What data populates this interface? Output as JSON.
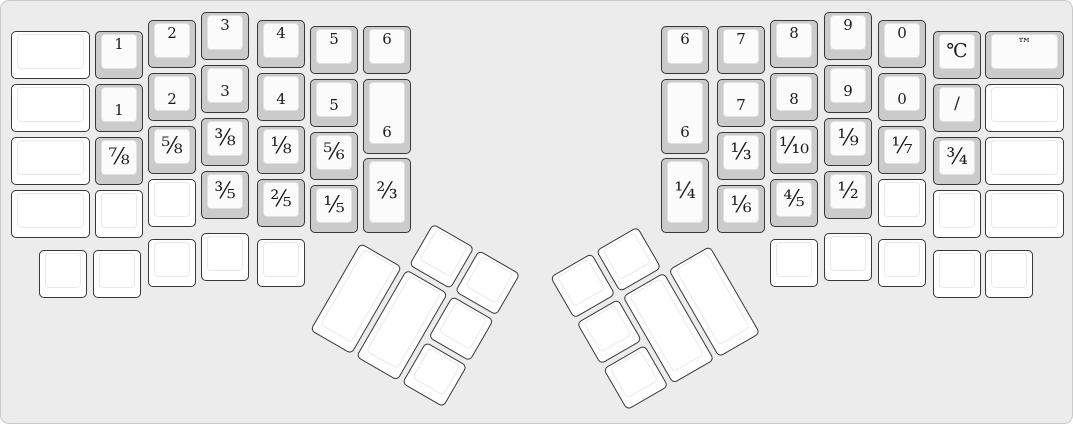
{
  "canvas": {
    "width": 1073,
    "height": 424,
    "background": "#ececec",
    "border_color": "#c9c9c9"
  },
  "key_style": {
    "labeled_base": "#cbcbcb",
    "labeled_top": "#fbfbfb",
    "blank_base": "#ffffff",
    "blank_top": "#ffffff",
    "outline": "#383838",
    "legend_color": "#1b1b1b",
    "unit_w": 48,
    "unit_h": 48
  },
  "groups": [
    {
      "name": "left-hand-main-keys",
      "rotation": 0,
      "origin": [
        0,
        0
      ],
      "keys": [
        {
          "x": 10,
          "y": 30,
          "w": 79,
          "label": "",
          "a": "c"
        },
        {
          "x": 10,
          "y": 83,
          "w": 79,
          "label": "",
          "a": "c"
        },
        {
          "x": 10,
          "y": 136,
          "w": 79,
          "label": "",
          "a": "c"
        },
        {
          "x": 10,
          "y": 189,
          "w": 79,
          "label": "",
          "a": "c"
        },
        {
          "x": 94,
          "y": 30,
          "label": "1",
          "a": "t"
        },
        {
          "x": 94,
          "y": 83,
          "label": "1",
          "a": "b"
        },
        {
          "x": 94,
          "y": 136,
          "label": "⅞",
          "a": "c"
        },
        {
          "x": 94,
          "y": 189,
          "label": "",
          "a": "c"
        },
        {
          "x": 147,
          "y": 19,
          "label": "2",
          "a": "t"
        },
        {
          "x": 147,
          "y": 72,
          "label": "2",
          "a": "b"
        },
        {
          "x": 147,
          "y": 125,
          "label": "⅝",
          "a": "c"
        },
        {
          "x": 147,
          "y": 178,
          "label": "",
          "a": "c"
        },
        {
          "x": 200,
          "y": 11,
          "label": "3",
          "a": "t"
        },
        {
          "x": 200,
          "y": 64,
          "label": "3",
          "a": "b"
        },
        {
          "x": 200,
          "y": 117,
          "label": "⅜",
          "a": "c"
        },
        {
          "x": 200,
          "y": 170,
          "label": "⅗",
          "a": "c"
        },
        {
          "x": 256,
          "y": 19,
          "label": "4",
          "a": "t"
        },
        {
          "x": 256,
          "y": 72,
          "label": "4",
          "a": "b"
        },
        {
          "x": 256,
          "y": 125,
          "label": "⅛",
          "a": "c"
        },
        {
          "x": 256,
          "y": 178,
          "label": "⅖",
          "a": "c"
        },
        {
          "x": 309,
          "y": 25,
          "label": "5",
          "a": "t"
        },
        {
          "x": 309,
          "y": 78,
          "label": "5",
          "a": "b"
        },
        {
          "x": 309,
          "y": 131,
          "label": "⅚",
          "a": "c"
        },
        {
          "x": 309,
          "y": 184,
          "label": "⅕",
          "a": "c"
        },
        {
          "x": 362,
          "y": 25,
          "label": "6",
          "a": "t"
        },
        {
          "x": 362,
          "y": 78,
          "h": 75,
          "label": "6",
          "a": "b"
        },
        {
          "x": 362,
          "y": 157,
          "h": 75,
          "label": "⅔",
          "a": "c"
        },
        {
          "x": 38,
          "y": 249,
          "label": "",
          "a": "c"
        },
        {
          "x": 92,
          "y": 249,
          "label": "",
          "a": "c"
        },
        {
          "x": 147,
          "y": 238,
          "label": "",
          "a": "c"
        },
        {
          "x": 200,
          "y": 232,
          "label": "",
          "a": "c"
        },
        {
          "x": 256,
          "y": 238,
          "label": "",
          "a": "c"
        }
      ]
    },
    {
      "name": "right-hand-main-keys",
      "rotation": 0,
      "origin": [
        0,
        0
      ],
      "keys": [
        {
          "x": 660,
          "y": 25,
          "label": "6",
          "a": "t"
        },
        {
          "x": 660,
          "y": 78,
          "h": 75,
          "label": "6",
          "a": "b"
        },
        {
          "x": 660,
          "y": 157,
          "h": 75,
          "label": "¼",
          "a": "c"
        },
        {
          "x": 716,
          "y": 25,
          "label": "7",
          "a": "t"
        },
        {
          "x": 716,
          "y": 78,
          "label": "7",
          "a": "b"
        },
        {
          "x": 716,
          "y": 131,
          "label": "⅓",
          "a": "c"
        },
        {
          "x": 716,
          "y": 184,
          "label": "⅙",
          "a": "c"
        },
        {
          "x": 769,
          "y": 19,
          "label": "8",
          "a": "t"
        },
        {
          "x": 769,
          "y": 72,
          "label": "8",
          "a": "b"
        },
        {
          "x": 769,
          "y": 125,
          "label": "⅒",
          "a": "c"
        },
        {
          "x": 769,
          "y": 178,
          "label": "⅘",
          "a": "c"
        },
        {
          "x": 823,
          "y": 11,
          "label": "9",
          "a": "t"
        },
        {
          "x": 823,
          "y": 64,
          "label": "9",
          "a": "b"
        },
        {
          "x": 823,
          "y": 117,
          "label": "⅑",
          "a": "c"
        },
        {
          "x": 823,
          "y": 170,
          "label": "½",
          "a": "c"
        },
        {
          "x": 877,
          "y": 19,
          "label": "0",
          "a": "t"
        },
        {
          "x": 877,
          "y": 72,
          "label": "0",
          "a": "b"
        },
        {
          "x": 877,
          "y": 125,
          "label": "⅐",
          "a": "c"
        },
        {
          "x": 877,
          "y": 178,
          "label": "",
          "a": "c"
        },
        {
          "x": 932,
          "y": 30,
          "label": "℃",
          "a": "c"
        },
        {
          "x": 932,
          "y": 83,
          "label": "/",
          "a": "c"
        },
        {
          "x": 932,
          "y": 136,
          "label": "¾",
          "a": "c"
        },
        {
          "x": 932,
          "y": 189,
          "label": "",
          "a": "c"
        },
        {
          "x": 984,
          "y": 30,
          "w": 79,
          "label": "™",
          "a": "t"
        },
        {
          "x": 984,
          "y": 83,
          "w": 79,
          "label": "",
          "a": "c"
        },
        {
          "x": 984,
          "y": 136,
          "w": 79,
          "label": "",
          "a": "c"
        },
        {
          "x": 984,
          "y": 189,
          "w": 79,
          "label": "",
          "a": "c"
        },
        {
          "x": 769,
          "y": 238,
          "label": "",
          "a": "c"
        },
        {
          "x": 823,
          "y": 232,
          "label": "",
          "a": "c"
        },
        {
          "x": 877,
          "y": 238,
          "label": "",
          "a": "c"
        },
        {
          "x": 932,
          "y": 249,
          "label": "",
          "a": "c"
        },
        {
          "x": 984,
          "y": 249,
          "label": "",
          "a": "c"
        }
      ]
    },
    {
      "name": "left-thumb-cluster",
      "rotation": 30,
      "origin": [
        386,
        196
      ],
      "keys": [
        {
          "x": 53,
          "y": 0,
          "label": "",
          "a": "c"
        },
        {
          "x": 106,
          "y": 0,
          "label": "",
          "a": "c"
        },
        {
          "x": 0,
          "y": 53,
          "h": 101,
          "label": "",
          "a": "c"
        },
        {
          "x": 53,
          "y": 53,
          "h": 101,
          "label": "",
          "a": "c"
        },
        {
          "x": 106,
          "y": 53,
          "label": "",
          "a": "c"
        },
        {
          "x": 106,
          "y": 106,
          "label": "",
          "a": "c"
        }
      ]
    },
    {
      "name": "right-thumb-cluster",
      "rotation": -30,
      "origin": [
        549,
        276
      ],
      "keys": [
        {
          "x": 0,
          "y": 0,
          "label": "",
          "a": "c"
        },
        {
          "x": 53,
          "y": 0,
          "label": "",
          "a": "c"
        },
        {
          "x": 0,
          "y": 53,
          "label": "",
          "a": "c"
        },
        {
          "x": 0,
          "y": 106,
          "label": "",
          "a": "c"
        },
        {
          "x": 53,
          "y": 53,
          "h": 101,
          "label": "",
          "a": "c"
        },
        {
          "x": 106,
          "y": 53,
          "h": 101,
          "label": "",
          "a": "c"
        }
      ]
    }
  ]
}
